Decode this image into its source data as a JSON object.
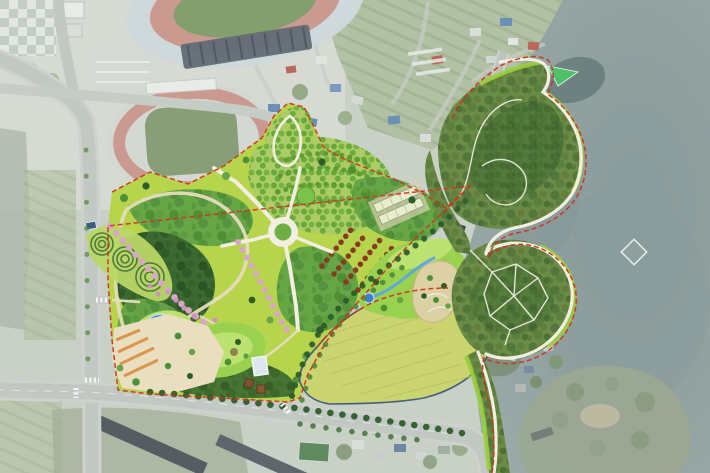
{
  "map": {
    "label": "Aerial masterplan rendering of a lakeside park",
    "regions": {
      "northwest": [
        "checkerboard-plaza",
        "stadium",
        "athletics-track",
        "parking-lot"
      ],
      "west_park": [
        "park-lawn",
        "conifer-grove",
        "orchard-grove",
        "central-ring-plaza",
        "spiral-gardens",
        "cherry-allee",
        "pond",
        "great-lawn",
        "southwest-plaza",
        "reflecting-pool",
        "pavilions",
        "greenhouses",
        "maple-rows"
      ],
      "center": [
        "diagonal-road",
        "open-meadow",
        "stream-garden",
        "sand-garden"
      ],
      "east": [
        "forest-peninsula",
        "lakeside-path",
        "trail-network",
        "green-lawn-point",
        "lake",
        "island",
        "water-marker"
      ],
      "edges": [
        "village-houses",
        "orchard-fields",
        "apartment-blocks",
        "sports-court",
        "city-roads",
        "crosswalks",
        "park-boundary"
      ]
    }
  },
  "palette": {
    "aerialBase": "#c6cdc1",
    "aerialUrban": "#d6dad4",
    "aerialField": "#a9bb97",
    "riverGray": "#a7b2a6",
    "lakeWater": "#8d9e9d",
    "lakeDeep": "#768a8a",
    "lakeDark": "#2f4c4a",
    "islandGreen": "#93a189",
    "islandSand": "#c9bf9e",
    "roadGray": "#c2c8c3",
    "roadMinor": "#bcc3bd",
    "trackRed": "#c79186",
    "fieldGreen": "#7c9669",
    "standRoof": "#525e66",
    "bldgWhite": "#e9ebe7",
    "roofBlue": "#5d86b0",
    "roofRed": "#b25a4a",
    "parkLawn": "#b6d44c",
    "lawnBright": "#9ad24f",
    "lawnLight": "#bce272",
    "forestDark": "#3c6a30",
    "forestMid": "#68a546",
    "forestOlive": "#6b8c46",
    "orchardBase": "#accd66",
    "rowGreen": "#5e9c34",
    "meadowYellow": "#cad470",
    "meadowOutline": "#2e4a78",
    "boundaryRed": "#d5301f",
    "pathWhite": "#f2eee0",
    "pathTan": "#e6dcbd",
    "plazaTan": "#e9dec0",
    "plazaStripe": "#da964e",
    "pondBlue": "#3f7ed2",
    "pondEdge": "#bfe3f2",
    "streamBlue": "#5fa8d8",
    "poolLight": "#dce8ee",
    "pinkTree": "#d9a6c8",
    "maroonTree": "#8a3a20",
    "sandGarden": "#dbd1a4",
    "greenPoint": "#4ec06a",
    "brightRim": "#9bcf3f",
    "greenhouse": "#e8eecb",
    "aptRoof": "#454d53",
    "courtGreen": "#4e7e52"
  }
}
